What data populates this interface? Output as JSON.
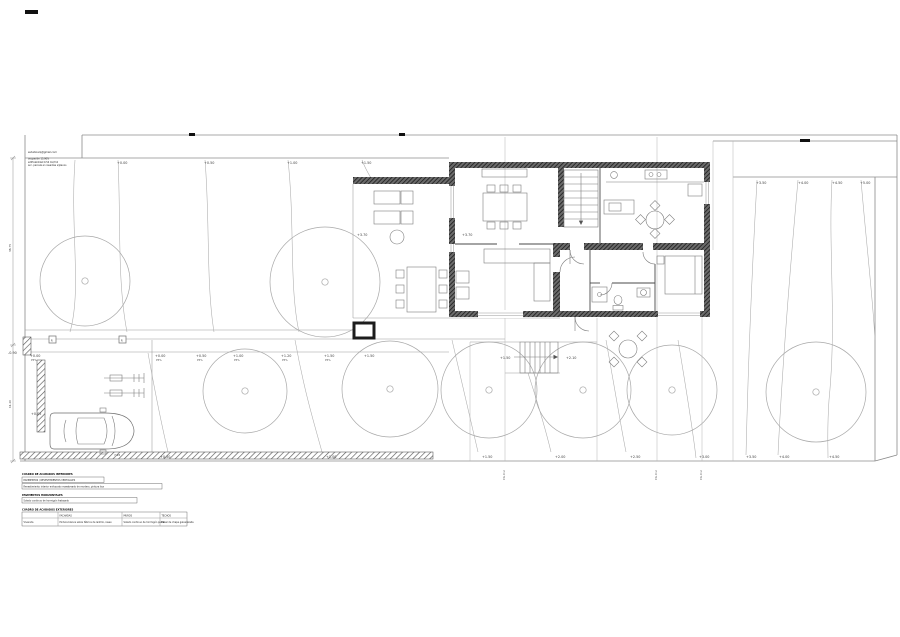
{
  "title": "plano de ordenación de parcela y planta de vivienda",
  "notes": {
    "email": "estudioarq@gmail.com",
    "line1": "ocupación 15.90%",
    "line2": "edificabilidad 0.54 m2/m2",
    "line3": "acc. parcela en rasantes s/planos"
  },
  "elev_labels": [
    {
      "t": "+0.00",
      "x": 117,
      "y": 164
    },
    {
      "t": "+0.50",
      "x": 204,
      "y": 164
    },
    {
      "t": "+1.00",
      "x": 287,
      "y": 164
    },
    {
      "t": "+1.50",
      "x": 361,
      "y": 164
    },
    {
      "t": "+3.50",
      "x": 756,
      "y": 184
    },
    {
      "t": "+4.00",
      "x": 798,
      "y": 184
    },
    {
      "t": "+4.50",
      "x": 832,
      "y": 184
    },
    {
      "t": "+5.00",
      "x": 860,
      "y": 184
    },
    {
      "t": "+0.00",
      "x": 30,
      "y": 357,
      "sub": "P5%"
    },
    {
      "t": "+0.00",
      "x": 155,
      "y": 357,
      "sub": "P5%"
    },
    {
      "t": "+0.50",
      "x": 196,
      "y": 357,
      "sub": "P5%"
    },
    {
      "t": "+1.00",
      "x": 233,
      "y": 357,
      "sub": "P5%"
    },
    {
      "t": "+1.20",
      "x": 281,
      "y": 357,
      "sub": "P5%"
    },
    {
      "t": "+1.50",
      "x": 324,
      "y": 357,
      "sub": "P5%"
    },
    {
      "t": "+1.50",
      "x": 364,
      "y": 357
    },
    {
      "t": "-0.90",
      "x": 8,
      "y": 354
    },
    {
      "t": "+0.05",
      "x": 31,
      "y": 415
    },
    {
      "t": "+0.50",
      "x": 160,
      "y": 458
    },
    {
      "t": "+1.00",
      "x": 326,
      "y": 458
    },
    {
      "t": "+1.50",
      "x": 482,
      "y": 458
    },
    {
      "t": "+2.00",
      "x": 555,
      "y": 458
    },
    {
      "t": "+2.50",
      "x": 630,
      "y": 458
    },
    {
      "t": "+3.00",
      "x": 699,
      "y": 458
    },
    {
      "t": "+3.50",
      "x": 746,
      "y": 458
    },
    {
      "t": "+4.00",
      "x": 779,
      "y": 458
    },
    {
      "t": "+4.50",
      "x": 829,
      "y": 458
    },
    {
      "t": "+1.50",
      "x": 500,
      "y": 359
    },
    {
      "t": "+2.10",
      "x": 566,
      "y": 359
    },
    {
      "t": "+3.70",
      "x": 357,
      "y": 236
    },
    {
      "t": "+3.70",
      "x": 462,
      "y": 236
    }
  ],
  "survey_tags": [
    {
      "t": "P.G.O.U.",
      "x": 505,
      "y": 480
    },
    {
      "t": "P.G.O.U.",
      "x": 657,
      "y": 480
    },
    {
      "t": "P.G.O.U.",
      "x": 702,
      "y": 480
    }
  ],
  "dims": {
    "left_upper": "38.75",
    "left_lower": "11.20",
    "garage_width": "7.95"
  },
  "markers": {
    "grille": "R"
  },
  "legend": {
    "finishes_int": {
      "title": "CUADRO DE ACABADOS INTERIORES",
      "row1": "PAVIMENTOS / REVESTIMIENTOS VERTICALES",
      "row2": "Revestimiento interior enfoscado maestreado de mortero, pintura lisa"
    },
    "pavements": {
      "title": "PAVIMENTOS HORIZONTALES",
      "row1": "Solado continuo de hormigón fratasado"
    },
    "finishes_ext": {
      "title": "CUADRO DE ACABADOS EXTERIORES",
      "col1": "FACHADAS",
      "col2": "MUROS",
      "col3": "TECHOS",
      "r1c0": "Vivienda",
      "r1c1": "Pintura blanca sobre fábrica de ladrillo, raseo",
      "r1c2": "Solado continuo de hormigón pulido",
      "r1c3": "Panel de chapa galvanizada"
    }
  }
}
